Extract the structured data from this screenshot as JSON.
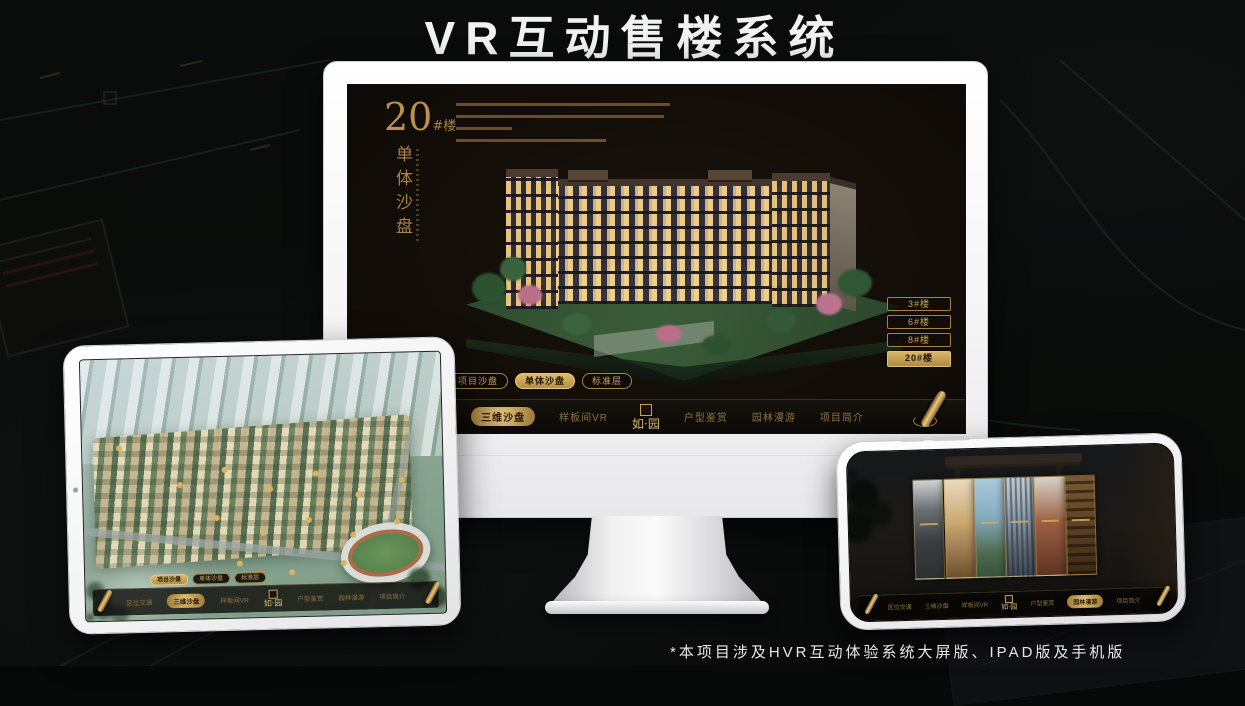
{
  "page": {
    "title": "VR互动售楼系统",
    "footnote": "*本项目涉及HVR互动体验系统大屏版、IPAD版及手机版"
  },
  "colors": {
    "gold_accent": "#c9a45a",
    "gold_deep": "#8a6327",
    "screen_background": "#120d08",
    "frame_white": "#f5f5f6"
  },
  "nav": {
    "logo": "如·园",
    "items": [
      "区位交通",
      "三维沙盘",
      "样板间VR",
      "户型鉴赏",
      "园林漫游",
      "项目简介"
    ]
  },
  "tabs": [
    "项目沙盘",
    "单体沙盘",
    "标准层"
  ],
  "monitor": {
    "building_no": "20",
    "building_suffix": "#楼",
    "subtitle": "单体沙盘",
    "active_tab": "单体沙盘",
    "active_nav": "三维沙盘",
    "floor_buttons": [
      {
        "label": "3#楼",
        "active": false
      },
      {
        "label": "6#楼",
        "active": false
      },
      {
        "label": "8#楼",
        "active": false
      },
      {
        "label": "20#楼",
        "active": true
      }
    ]
  },
  "tablet": {
    "active_tab": "项目沙盘",
    "active_nav": "三维沙盘"
  },
  "phone": {
    "active_nav": "园林漫游"
  }
}
